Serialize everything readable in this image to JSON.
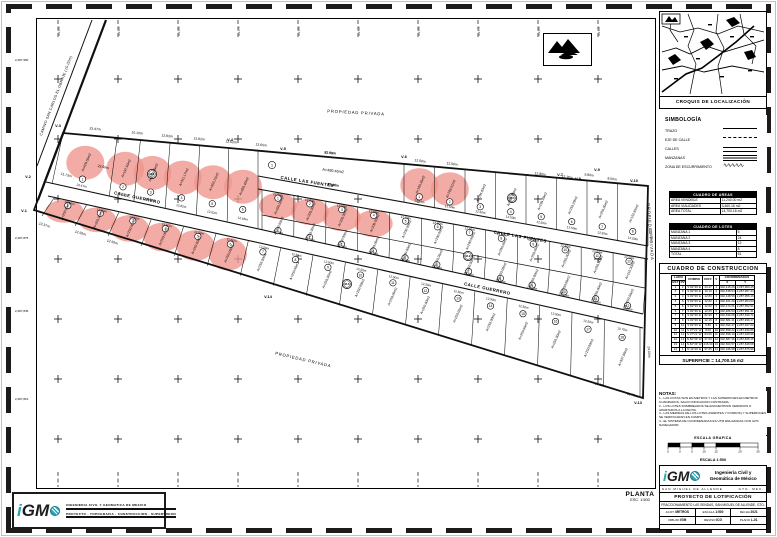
{
  "colors": {
    "pink": "#f0958c",
    "teal": "#29a5b3",
    "ink": "#111111"
  },
  "plan": {
    "road_label": {
      "t": "CAMINO SAN CARLOS EL OBRAJE (15.00m)",
      "x": 57,
      "y": 96,
      "r": -69
    },
    "street_labels": [
      {
        "t": "CALLE LAS FUENTES",
        "x": 307,
        "y": 183,
        "r": 9
      },
      {
        "t": "CALLE LAS FUENTES",
        "x": 520,
        "y": 238,
        "r": 10
      },
      {
        "t": "CALLE GUERRERO",
        "x": 137,
        "y": 199,
        "r": 12
      },
      {
        "t": "CALLE GUERRERO",
        "x": 487,
        "y": 290,
        "r": 12
      }
    ],
    "zone_labels": [
      {
        "t": "PROPIEDAD PRIVADA",
        "x": 356,
        "y": 114,
        "r": 3
      },
      {
        "t": "PROPIEDAD PRIVADA",
        "x": 649,
        "y": 232,
        "r": 86
      },
      {
        "t": "PROPIEDAD PRIVADA",
        "x": 303,
        "y": 361,
        "r": 13
      }
    ],
    "vertices": [
      {
        "t": "V-1",
        "x": 24,
        "y": 212
      },
      {
        "t": "V-2",
        "x": 28,
        "y": 178
      },
      {
        "t": "V-3",
        "x": 58,
        "y": 127
      },
      {
        "t": "V-4",
        "x": 230,
        "y": 141
      },
      {
        "t": "V-5",
        "x": 283,
        "y": 150
      },
      {
        "t": "V-6",
        "x": 404,
        "y": 158
      },
      {
        "t": "V-7",
        "x": 560,
        "y": 176
      },
      {
        "t": "V-8",
        "x": 578,
        "y": 180
      },
      {
        "t": "V-9",
        "x": 597,
        "y": 171
      },
      {
        "t": "V-10",
        "x": 634,
        "y": 182
      },
      {
        "t": "V-13",
        "x": 638,
        "y": 404
      },
      {
        "t": "V-14",
        "x": 268,
        "y": 298
      }
    ],
    "dims": [
      {
        "t": "23.47m",
        "x": 95,
        "y": 130,
        "r": 6
      },
      {
        "t": "10.10m",
        "x": 137,
        "y": 134,
        "r": 6
      },
      {
        "t": "12.83m",
        "x": 167,
        "y": 137,
        "r": 6
      },
      {
        "t": "12.82m",
        "x": 199,
        "y": 140,
        "r": 6
      },
      {
        "t": "12.62m",
        "x": 231,
        "y": 143,
        "r": 6
      },
      {
        "t": "12.65m",
        "x": 261,
        "y": 146,
        "r": 6
      },
      {
        "t": "82.99m",
        "x": 330,
        "y": 154,
        "r": 5
      },
      {
        "t": "82.46m",
        "x": 333,
        "y": 186,
        "r": 8
      },
      {
        "t": "12.50m",
        "x": 420,
        "y": 162,
        "r": 7
      },
      {
        "t": "12.50m",
        "x": 452,
        "y": 165,
        "r": 7
      },
      {
        "t": "12.80m",
        "x": 540,
        "y": 175,
        "r": 7
      },
      {
        "t": "12.16m",
        "x": 567,
        "y": 178,
        "r": 7
      },
      {
        "t": "5.80m",
        "x": 589,
        "y": 176,
        "r": 7
      },
      {
        "t": "8.00m",
        "x": 612,
        "y": 180,
        "r": 7
      },
      {
        "t": "11.73m",
        "x": 66,
        "y": 176,
        "r": 15
      },
      {
        "t": "23.50m",
        "x": 103,
        "y": 168,
        "r": 12
      },
      {
        "t": "13.37m",
        "x": 44,
        "y": 226,
        "r": 17
      },
      {
        "t": "12.50m",
        "x": 80,
        "y": 234,
        "r": 17
      },
      {
        "t": "12.50m",
        "x": 112,
        "y": 243,
        "r": 17
      },
      {
        "t": "21.85m",
        "x": 650,
        "y": 235,
        "r": 86
      },
      {
        "t": "24.00m",
        "x": 648,
        "y": 352,
        "r": 86
      },
      {
        "t": "27.00m",
        "x": 600,
        "y": 386,
        "r": 14
      },
      {
        "t": "13.75m",
        "x": 632,
        "y": 396,
        "r": 16
      }
    ],
    "big_lot": {
      "num": "1",
      "top_len": "82.99m",
      "area": "A=490.46m2",
      "bottom_len": "82.46m"
    },
    "blocks": [
      {
        "t": "M-1",
        "x": 152,
        "y": 174
      },
      {
        "t": "M-2",
        "x": 468,
        "y": 256
      },
      {
        "t": "M-3",
        "x": 347,
        "y": 284
      },
      {
        "t": "M-4",
        "x": 512,
        "y": 198
      }
    ],
    "coord_labels": [
      {
        "t": "2,287,950",
        "x": 15,
        "y": 61
      },
      {
        "t": "2,287,875",
        "x": 15,
        "y": 239
      },
      {
        "t": "2,287,845",
        "x": 15,
        "y": 312
      },
      {
        "t": "2,287,810",
        "x": 15,
        "y": 400
      }
    ],
    "strips": [
      {
        "front": [
          52,
          184,
          258,
          228
        ],
        "back": [
          63,
          133,
          258,
          150
        ],
        "lots": [
          {
            "n": "1",
            "w": 23.47,
            "wl": "23.47m",
            "area": "A=420.50m2",
            "pink": true
          },
          {
            "n": "2",
            "w": 10.1,
            "wl": "10.10m",
            "area": "A=197.50m2",
            "pink": true
          },
          {
            "n": "3",
            "w": 12.83,
            "wl": "12.83m",
            "area": "A=288.19m2",
            "pink": true
          },
          {
            "n": "4",
            "w": 12.82,
            "wl": "12.82m",
            "area": "A=311.17m2",
            "pink": true
          },
          {
            "n": "5",
            "w": 12.62,
            "wl": "12.62m",
            "area": "A=353.15m2",
            "pink": true
          },
          {
            "n": "6",
            "w": 12.65,
            "wl": "12.65m",
            "area": "A=358.40m2",
            "pink": true
          }
        ]
      },
      {
        "front": [
          404,
          202,
          648,
          246
        ],
        "back": [
          404,
          164,
          648,
          186
        ],
        "lots": [
          {
            "n": "1",
            "w": 12.5,
            "wl": "12.50m",
            "area": "A=160.30m2",
            "pink": true
          },
          {
            "n": "2",
            "w": 12.5,
            "wl": "12.50m",
            "area": "A=183.01m2",
            "pink": true
          },
          {
            "n": "3",
            "w": 12.5,
            "wl": "12.50m",
            "area": "A=164.63m2"
          },
          {
            "n": "4",
            "w": 12.5,
            "wl": "12.50m",
            "area": "A=318.65m2"
          },
          {
            "n": "5",
            "w": 12.5,
            "wl": "12.50m",
            "area": "A=239.49m2"
          },
          {
            "n": "6",
            "w": 12.5,
            "wl": "12.50m",
            "area": "A=250.29m2"
          },
          {
            "n": "7",
            "w": 12.5,
            "wl": "12.50m",
            "area": "A=250.00m2"
          },
          {
            "n": "8",
            "w": 12.5,
            "wl": "12.50m",
            "area": "A=152.65m2"
          }
        ]
      },
      {
        "front": [
          262,
          190,
          645,
          258
        ],
        "back": [
          262,
          216,
          645,
          289
        ],
        "lots": [
          {
            "n": "1",
            "count": 4,
            "w": 12.5,
            "wl": "12.50m",
            "area": "A=200.00m2",
            "pink": true
          },
          {
            "n": "5",
            "count": 4,
            "w": 12.5,
            "wl": "12.50m",
            "area": "A=200.00m2"
          },
          {
            "n": "9",
            "count": 3,
            "w": 12.5,
            "wl": "12.50m",
            "area": "A=250.00m2"
          },
          {
            "n": "12",
            "w": 12.5,
            "wl": "12.50m",
            "area": "A=210.30m2"
          }
        ]
      },
      {
        "front": [
          262,
          230,
          643,
          314
        ],
        "back": [
          262,
          216,
          645,
          289
        ],
        "lots": [
          {
            "n": "1",
            "count": 12,
            "w": 12.5,
            "wl": "12.50m",
            "area": "A=250.00m2"
          }
        ]
      },
      {
        "front": [
          54,
          198,
          640,
          328
        ],
        "back": [
          42,
          216,
          640,
          396
        ],
        "lots": [
          {
            "n": "1",
            "count": 6,
            "w": 12.5,
            "wl": "12.50m",
            "area": "A=250.00m2",
            "pink": true
          },
          {
            "n": "7",
            "count": 11,
            "w": 12.5,
            "wl": "12.50m",
            "area": "A=250.00m2"
          },
          {
            "n": "18",
            "w": 13.75,
            "wl": "13.75m",
            "area": "A=337.68m2"
          }
        ]
      }
    ],
    "planta": {
      "title": "PLANTA",
      "scale": "ESC. 1:500"
    }
  },
  "sidebar": {
    "croquis_title": "CROQUIS DE LOCALIZACIÓN",
    "simbologia": {
      "title": "SIMBOLOGÍA",
      "items": [
        {
          "label": "TRAZO",
          "sym": "line"
        },
        {
          "label": "EJE DE CALLE",
          "sym": "dash"
        },
        {
          "label": "CALLES",
          "sym": "double"
        },
        {
          "label": "MANZANAS",
          "sym": "hatch"
        },
        {
          "label": "ZONA DE ESCURRIMIENTO",
          "sym": "zig"
        }
      ]
    },
    "mini_tables": [
      {
        "title": "CUADRO DE AREAS",
        "rows": [
          [
            "AREA VENDIBLE",
            "11,240.00 m2"
          ],
          [
            "AREA VIALIDADES",
            "3,460.16 m2"
          ],
          [
            "AREA TOTAL",
            "14,700.16 m2"
          ]
        ]
      },
      {
        "title": "CUADRO DE LOTES",
        "rows": [
          [
            "MANZANA 1",
            "6"
          ],
          [
            "MANZANA 2",
            "24"
          ],
          [
            "MANZANA 3",
            "13"
          ],
          [
            "MANZANA 4",
            "8"
          ],
          [
            "TOTAL",
            "51"
          ]
        ]
      }
    ],
    "cuadro": {
      "title": "CUADRO DE CONSTRUCCION",
      "col_lado": "LADO",
      "col_est": "EST",
      "col_pv": "PV",
      "col_rumbo": "RUMBO",
      "col_dist": "DIST.",
      "col_v": "V",
      "col_coord": "COORDENADAS",
      "col_x": "X",
      "col_y": "Y",
      "rows": [
        [
          "1",
          "2",
          "S 82°39' E",
          "23.47",
          "1",
          "302,415.26",
          "2,287,960.45"
        ],
        [
          "2",
          "3",
          "S 82°39' E",
          "10.10",
          "2",
          "302,438.54",
          "2,287,957.44"
        ],
        [
          "3",
          "4",
          "S 82°39' E",
          "12.83",
          "3",
          "302,448.56",
          "2,287,956.16"
        ],
        [
          "4",
          "5",
          "S 82°39' E",
          "12.82",
          "4",
          "302,461.29",
          "2,287,954.53"
        ],
        [
          "5",
          "6",
          "S 82°39' E",
          "12.62",
          "5",
          "302,474.01",
          "2,287,952.91"
        ],
        [
          "6",
          "7",
          "S 82°39' E",
          "12.65",
          "6",
          "302,486.53",
          "2,287,951.31"
        ],
        [
          "7",
          "8",
          "S 82°39' E",
          "82.99",
          "7",
          "302,499.08",
          "2,287,949.71"
        ],
        [
          "8",
          "9",
          "S 82°39' E",
          "12.16",
          "8",
          "302,581.41",
          "2,287,939.17"
        ],
        [
          "9",
          "10",
          "S 82°39' E",
          "5.80",
          "9",
          "302,593.47",
          "2,287,937.62"
        ],
        [
          "10",
          "11",
          "S 07°21' W",
          "8.00",
          "10",
          "302,599.22",
          "2,287,936.89"
        ],
        [
          "11",
          "12",
          "S 07°21' W",
          "84.50",
          "11",
          "302,598.19",
          "2,287,928.96"
        ],
        [
          "12",
          "13",
          "N 82°39' W",
          "27.00",
          "12",
          "302,587.36",
          "2,287,845.15"
        ],
        [
          "13",
          "14",
          "N 82°39' W",
          "215.30",
          "13",
          "302,560.57",
          "2,287,848.58"
        ],
        [
          "14",
          "1",
          "N 12°40' E",
          "97.65",
          "14",
          "302,346.98",
          "2,287,875.96"
        ]
      ],
      "superficie": "SUPERFICIE = 14,700.16 m2"
    },
    "notas": {
      "title": "NOTAS:",
      "lines": [
        "1.- LAS COTAS SON EN METROS Y LAS SUPERFICIES EN METROS CUADRADOS, SALVO INDICACION CONTRARIA.",
        "2.- LOS LOTES SOMBREADOS SE ENCUENTRAN VENDIDOS O APARTADOS A LA FECHA.",
        "3.- LAS MEDIDAS DE LOS LOTES (FRENTES Y FONDOS) Y SUPERFICIES SE VERIFICARAN EN CAMPO.",
        "4.- EL SISTEMA DE COORDENADAS ES UTM ENLAZADAS CON GPS NAVEGADOR."
      ]
    },
    "escala": {
      "grafica_label": "ESCALA GRAFICA",
      "text": "ESCALA 1:500",
      "bar_numbers": [
        "5",
        "0",
        "5",
        "10",
        "15",
        "20",
        "25"
      ]
    },
    "firm": {
      "name_line1": "Ingeniería Civil y",
      "name_line2": "Geomática de México"
    },
    "titleblock": {
      "row1_left": "SAN MIGUEL DE ALLENDE",
      "row1_right": "GTO. MEX.",
      "project": "PROYECTO DE LOTIFICACIÓN",
      "subtitle": "FRACCIONAMIENTO LAS SENDAS, SAN MIGUEL DE ALLENDE, GTO.",
      "cells1": [
        {
          "k": "ACOT.",
          "v": "METROS"
        },
        {
          "k": "ESCALA",
          "v": "1:500"
        },
        {
          "k": "FECHA",
          "v": "2021"
        }
      ],
      "cells2": [
        {
          "k": "DIBUJO",
          "v": "IGM"
        },
        {
          "k": "REVISO",
          "v": "ICG"
        },
        {
          "k": "PLANO",
          "v": "L-01"
        }
      ]
    }
  },
  "footer_logo": {
    "line1": "INGENIERIA CIVIL Y GEOMATICA DE MEXICO",
    "line2": "PROYECTO · TOPOGRAFIA · CONSTRUCCION · SUPERVISION"
  }
}
